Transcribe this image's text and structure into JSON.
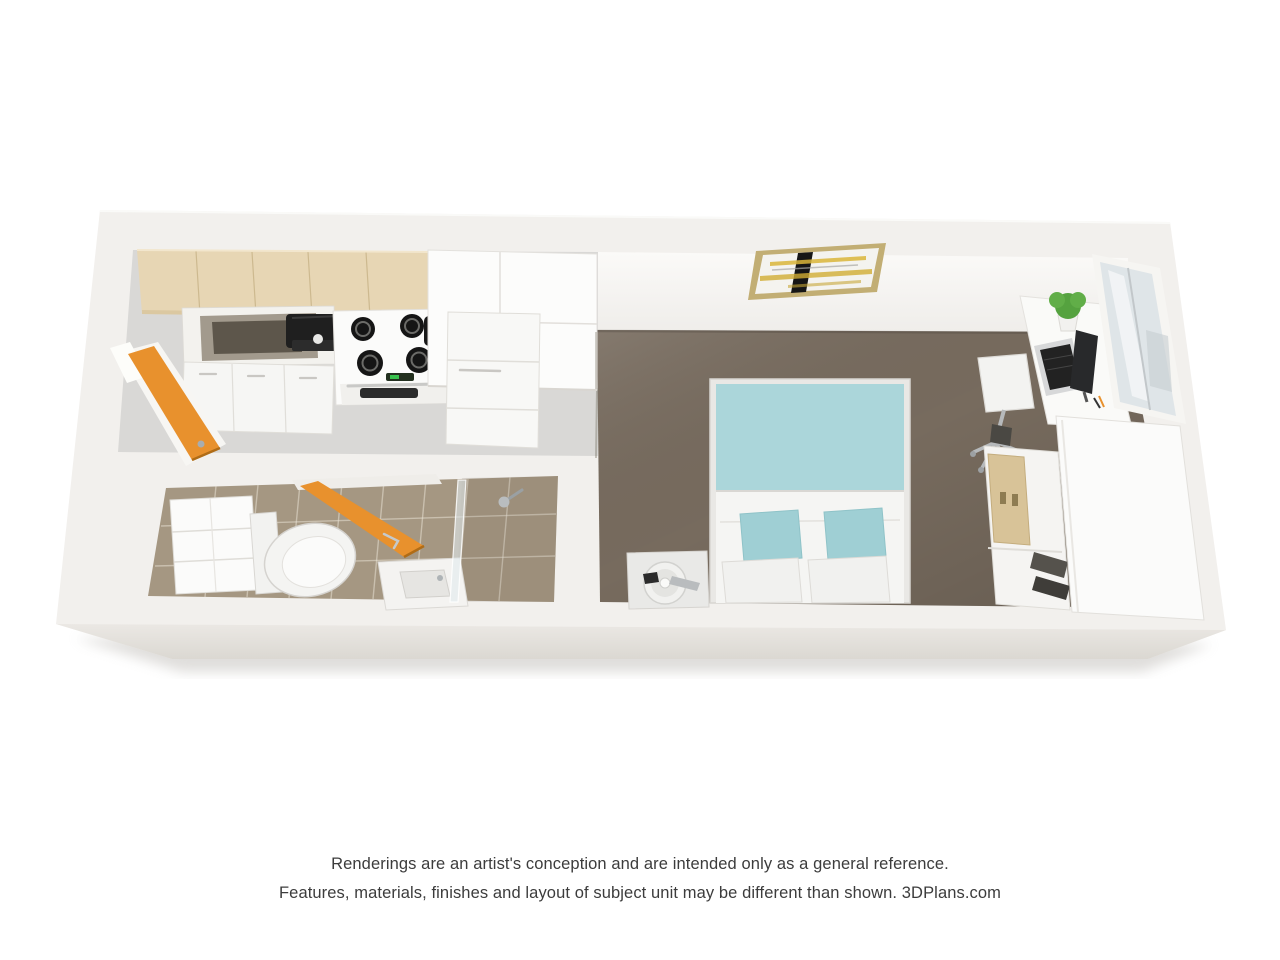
{
  "page": {
    "background": "#ffffff",
    "width": 1280,
    "height": 960
  },
  "disclaimer": {
    "line1": "Renderings are an artist's conception and are intended only as a general reference.",
    "line2": "Features, materials, finishes and layout of subject unit may be different than shown. 3DPlans.com",
    "brand": "3DPlans.com",
    "text_color": "#3c3c3c"
  },
  "floorplan": {
    "type": "3d-studio-apartment-floor-plan-top-view",
    "colors": {
      "wall": "#f2f0ed",
      "wall_face": "#f9f8f5",
      "wall_bevel": "#e4e1dc",
      "kitchen_floor": "#d9d8d6",
      "bathroom_tile": "#a59782",
      "carpet": "#776b5e",
      "cabinet_tan": "#e7d6b4",
      "door_orange": "#e8912d",
      "bedding_teal": "#abd6da",
      "white_furniture": "#fbfbfa",
      "glass": "#dfe5e8",
      "plant_green": "#55a23f",
      "art_yellow": "#d9b53a",
      "art_black": "#161616"
    },
    "rooms": [
      {
        "name": "kitchen",
        "floor": "gray vinyl"
      },
      {
        "name": "bathroom",
        "floor": "tan tile"
      },
      {
        "name": "bedroom-living",
        "floor": "brown carpet"
      }
    ],
    "furniture": [
      "upper-cabinets",
      "kitchen-sink",
      "coffee-maker",
      "stove",
      "refrigerator",
      "dishwasher",
      "entry-door",
      "bathroom-door",
      "storage-shelf",
      "toilet",
      "vanity-sink",
      "shower",
      "bed",
      "nightstand",
      "table-fan",
      "wall-art",
      "desk",
      "office-chair",
      "laptop",
      "monitor",
      "desk-plant",
      "window",
      "wardrobe",
      "shelf-boxes",
      "shoes"
    ]
  }
}
